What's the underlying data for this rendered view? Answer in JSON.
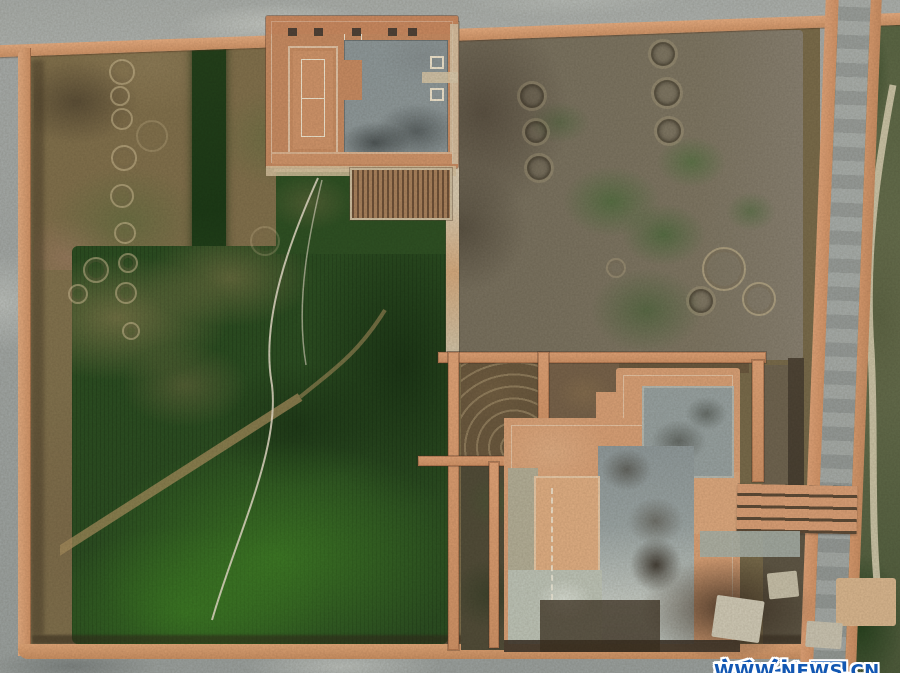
{
  "meta": {
    "domain": "Natural-Image",
    "description": "Aerial drone photograph of an archaeological excavation site: two unearthed building foundations with salmon-colored rammed-earth platforms and gray stone cores, enclosed by boundary walls, surrounded by mottled green and brown fields bearing circular crop-marks, with gray perimeter roads."
  },
  "watermark": {
    "logo": "新华网",
    "url": "WWW.NEWS.CN",
    "logo_color": "#1257b2",
    "outline_color": "#ffffff"
  },
  "palette": {
    "road_gray": "#a4a9a6",
    "boundary_wall_salmon": "#dda077",
    "field_olive": "#84744f",
    "field_dark_green": "#2c4e22",
    "field_bright_green": "#3f7d28",
    "right_field_brown": "#7b7260",
    "platform_salmon": "#d8a076",
    "stone_gray": "#97a1a1",
    "trace_white": "#eee3cf"
  }
}
